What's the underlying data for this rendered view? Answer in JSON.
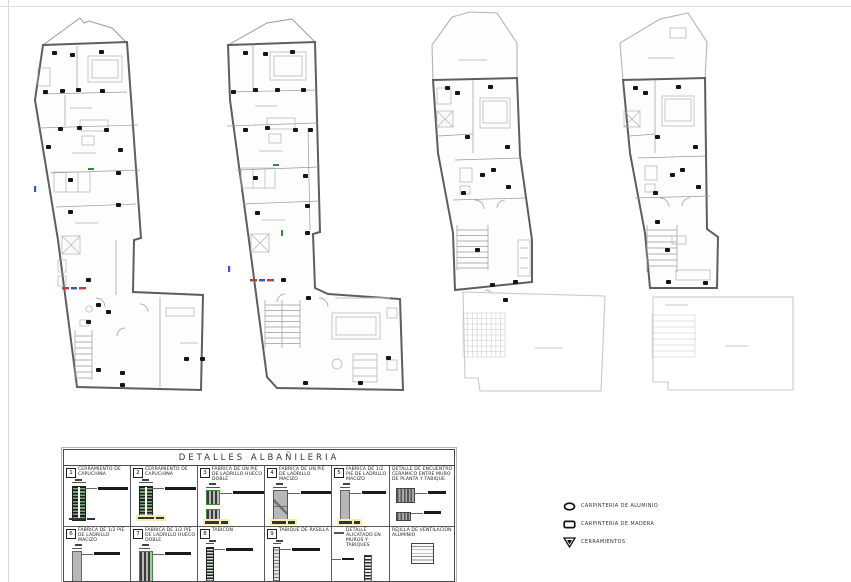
{
  "details_table": {
    "title": "DETALLES ALBAÑILERIA",
    "cells": [
      {
        "num": "1",
        "label": "CERRAMIENTO DE CAPUCHINA"
      },
      {
        "num": "2",
        "label": "CERRAMIENTO DE CAPUCHINA"
      },
      {
        "num": "3",
        "label": "FABRICA DE UN PIE DE LADRILLO HUECO DOBLE"
      },
      {
        "num": "4",
        "label": "FABRICA DE UN PIE DE LADRILLO MACIZO"
      },
      {
        "num": "5",
        "label": "FABRICA DE 1/2 PIE DE LADRILLO MACIZO"
      },
      {
        "num": "",
        "label": "DETALLE DE ENCUENTRO CERAMICO ENTRE MURO DE PLANTA Y TABIQUE"
      },
      {
        "num": "6",
        "label": "FABRICA DE 1/2 PIE DE LADRILLO MACIZO"
      },
      {
        "num": "7",
        "label": "FABRICA DE 1/2 PIE DE LADRILLO HUECO DOBLE"
      },
      {
        "num": "8",
        "label": "TABICON"
      },
      {
        "num": "9",
        "label": "TABIQUE DE RASILLA"
      },
      {
        "num": "",
        "label": "DETALLE ALICATADO EN MUROS Y TABIQUES"
      },
      {
        "num": "",
        "label": "REJILLA DE VENTILACION ALUMINIO"
      }
    ]
  },
  "legend": {
    "items": [
      {
        "icon": "ellipse-icon",
        "label": "CARPINTERIA DE ALUMINIO"
      },
      {
        "icon": "rect-icon",
        "label": "CARPINTERIA DE MADERA"
      },
      {
        "icon": "triangle-icon",
        "label": "CERRAMIENTOS"
      }
    ]
  },
  "colors": {
    "masonry_green": "#3a8a3a",
    "tile_magenta": "#a43aa4",
    "highlight_yellow": "#f4edb4",
    "wall_gray": "#5e5e5e",
    "terrace_gray": "#c6c6c6",
    "marker_black": "#151515",
    "accent_red": "#c23b3b",
    "accent_blue": "#3b55c2"
  }
}
